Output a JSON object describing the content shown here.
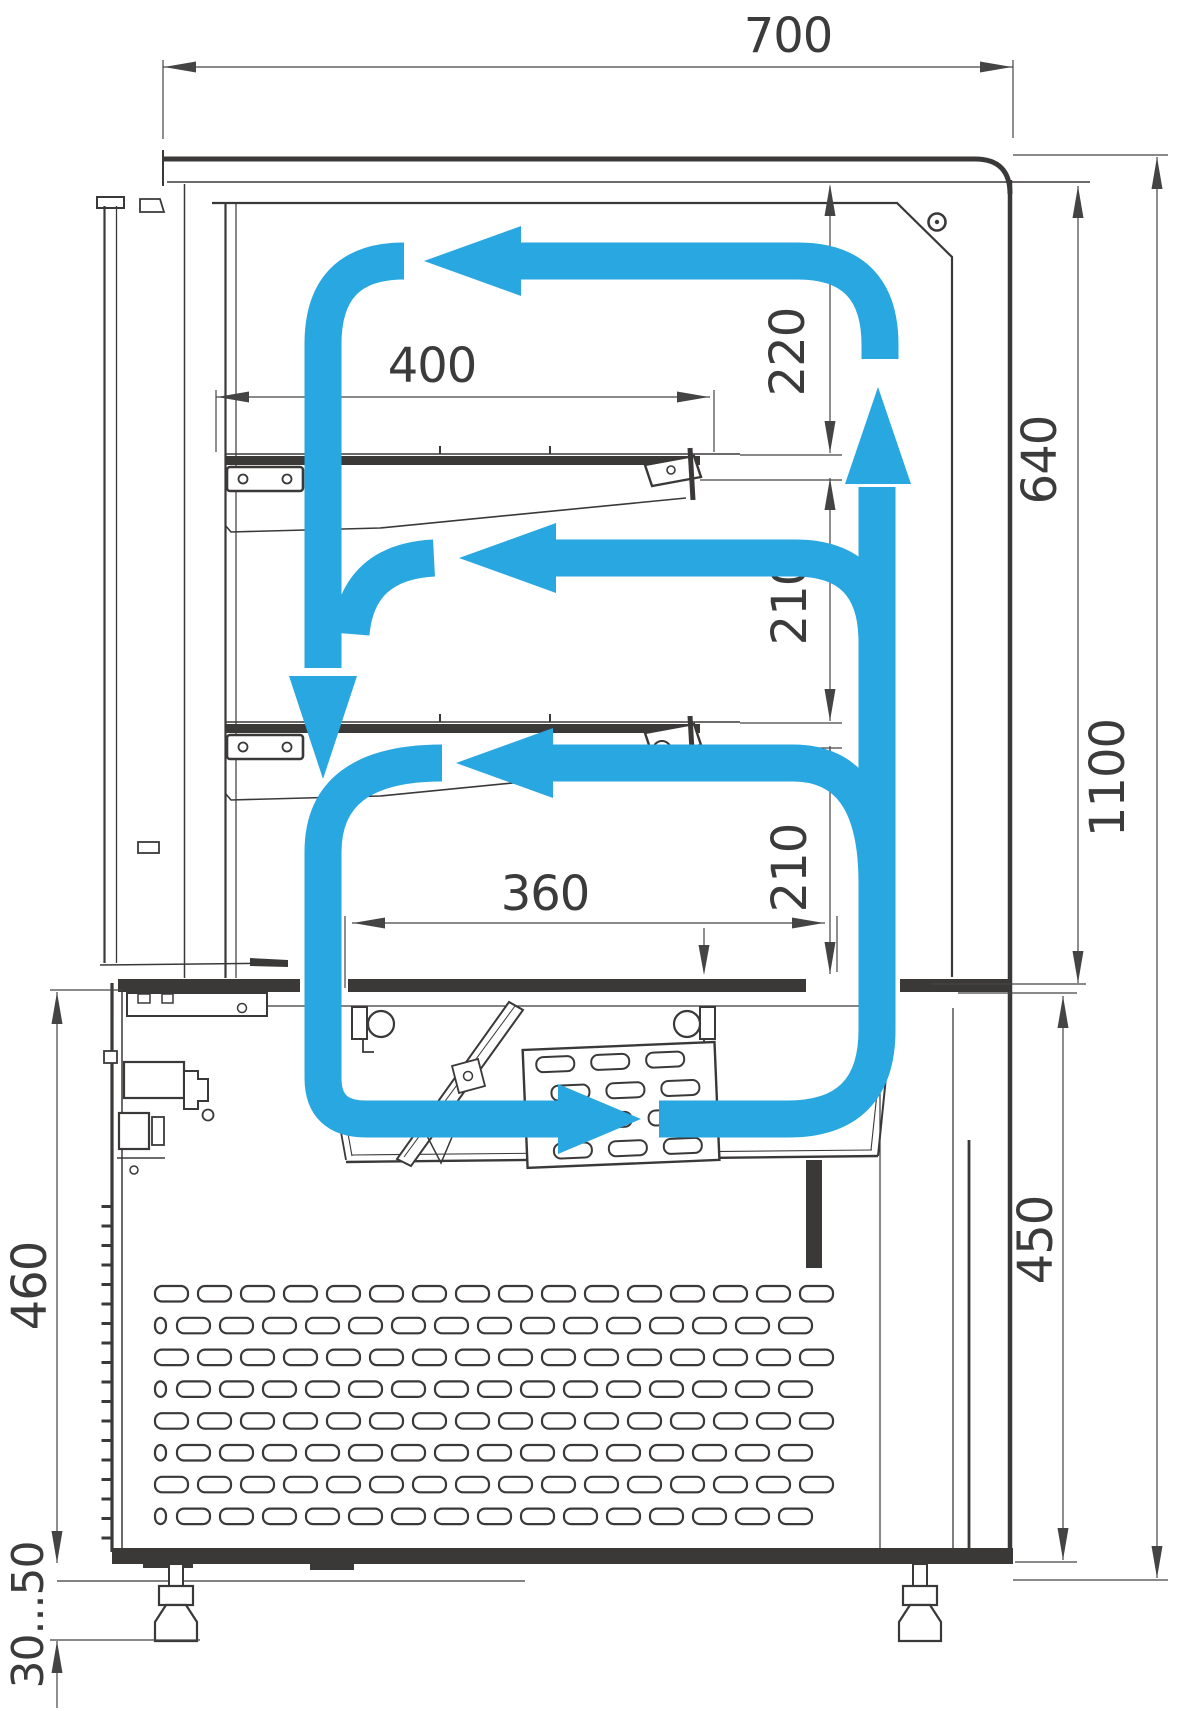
{
  "meta": {
    "title": "Refrigerated confectionery display case — sectional drawing with air circulation"
  },
  "colors": {
    "airflow_blue": "#29A7E0",
    "line_dark": "#3b3838",
    "dim_line": "#444444"
  },
  "dimensions": {
    "top_width": {
      "value": "700"
    },
    "upper_shelf_width": {
      "value": "400"
    },
    "lower_shelf_width": {
      "value": "360"
    },
    "top_clearance": {
      "value": "220"
    },
    "middle_clearance": {
      "value": "210"
    },
    "lower_clearance": {
      "value": "210"
    },
    "display_chamber_height": {
      "value": "640"
    },
    "overall_height": {
      "value": "1100"
    },
    "base_right_height": {
      "value": "450"
    },
    "base_left_height": {
      "value": "460"
    },
    "leg_adjustment_range": {
      "value": "30...50"
    }
  }
}
